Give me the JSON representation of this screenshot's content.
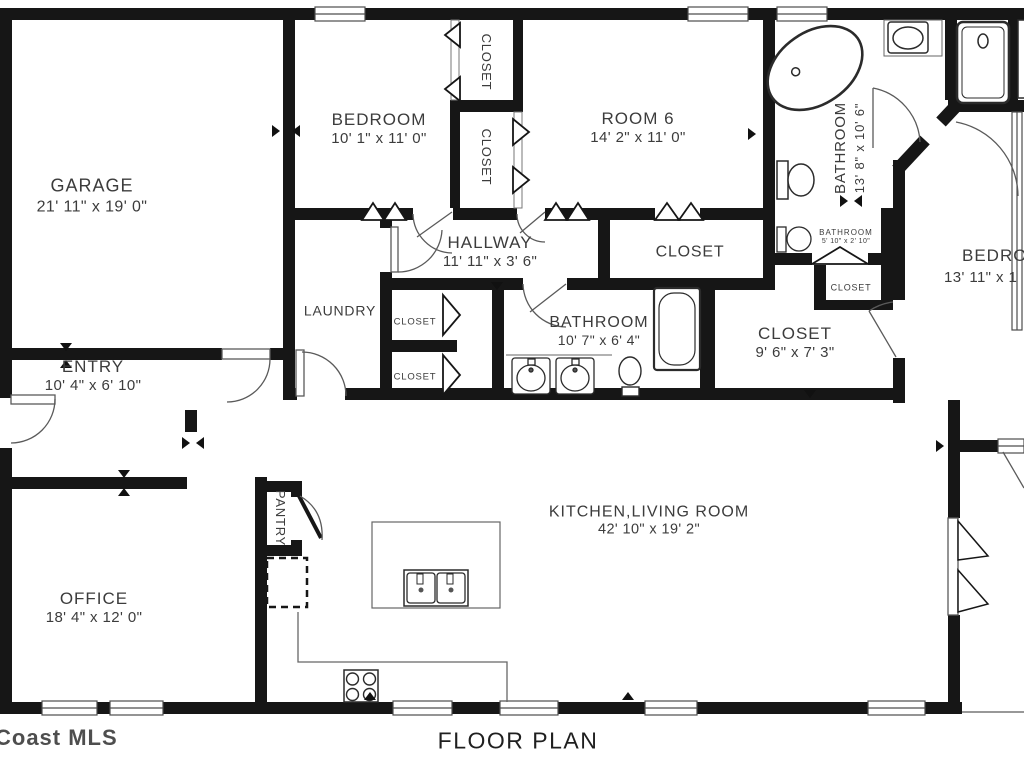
{
  "title": "FLOOR PLAN",
  "watermark": "Coast MLS",
  "colors": {
    "wall": "#161616",
    "thin_line": "#555555",
    "text": "#3c3c3c",
    "background": "#ffffff"
  },
  "fixtures": [
    "bathtub",
    "shower",
    "sink",
    "toilet",
    "double-vanity",
    "island-sink",
    "stove",
    "refrigerator-dashed"
  ],
  "rooms": {
    "garage": {
      "name": "GARAGE",
      "dims": "21' 11\" x 19' 0\""
    },
    "bedroom1": {
      "name": "BEDROOM",
      "dims": "10' 1\" x 11' 0\""
    },
    "closet_top": {
      "name": "CLOSET"
    },
    "closet_mid": {
      "name": "CLOSET"
    },
    "room6": {
      "name": "ROOM 6",
      "dims": "14' 2\" x 11' 0\""
    },
    "bathroom_master": {
      "name": "BATHROOM",
      "dims": "13' 8\" x 10' 6\""
    },
    "hallway": {
      "name": "HALLWAY",
      "dims": "11' 11\" x 3' 6\""
    },
    "closet_room6": {
      "name": "CLOSET"
    },
    "bathroom_small": {
      "name": "BATHROOM",
      "dims": "5' 10\" x 2' 10\""
    },
    "closet_small": {
      "name": "CLOSET"
    },
    "bedroom2": {
      "name": "BEDROOM",
      "dims": "13' 11\" x 1"
    },
    "laundry": {
      "name": "LAUNDRY"
    },
    "closet_hall_upper": {
      "name": "CLOSET"
    },
    "closet_hall_lower": {
      "name": "CLOSET"
    },
    "bathroom2": {
      "name": "BATHROOM",
      "dims": "10' 7\" x 6' 4\""
    },
    "closet_walkin": {
      "name": "CLOSET",
      "dims": "9' 6\" x 7' 3\""
    },
    "entry": {
      "name": "ENTRY",
      "dims": "10' 4\" x 6' 10\""
    },
    "pantry": {
      "name": "PANTRY"
    },
    "office": {
      "name": "OFFICE",
      "dims": "18' 4\" x 12' 0\""
    },
    "kitchen_living": {
      "name": "KITCHEN,LIVING ROOM",
      "dims": "42' 10\" x 19' 2\""
    }
  }
}
